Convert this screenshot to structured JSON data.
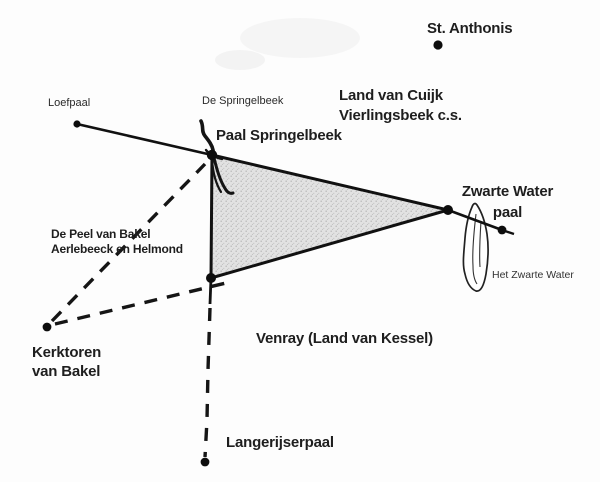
{
  "map": {
    "colors": {
      "background": "#fdfdfd",
      "ink": "#1b1b1b",
      "territory_fill": "#d9d9d9"
    },
    "labels": {
      "st_anthonis": "St. Anthonis",
      "region_north_line1": "Land van Cuijk",
      "region_north_line2": "Vierlingsbeek c.s.",
      "loefpaal": "Loefpaal",
      "springelbeek_stream": "De Springelbeek",
      "paal_springelbeek": "Paal Springelbeek",
      "zwarte_water_paal_line1": "Zwarte Water",
      "zwarte_water_paal_line2": "paal",
      "het_zwarte_water": "Het Zwarte Water",
      "peel_claim_line1": "De Peel van Bakel",
      "peel_claim_line2": "Aerlebeeck en Helmond",
      "kerktoren_line1": "Kerktoren",
      "kerktoren_line2": "van Bakel",
      "region_south": "Venray (Land van Kessel)",
      "langerijserpaal": "Langerijserpaal"
    }
  }
}
